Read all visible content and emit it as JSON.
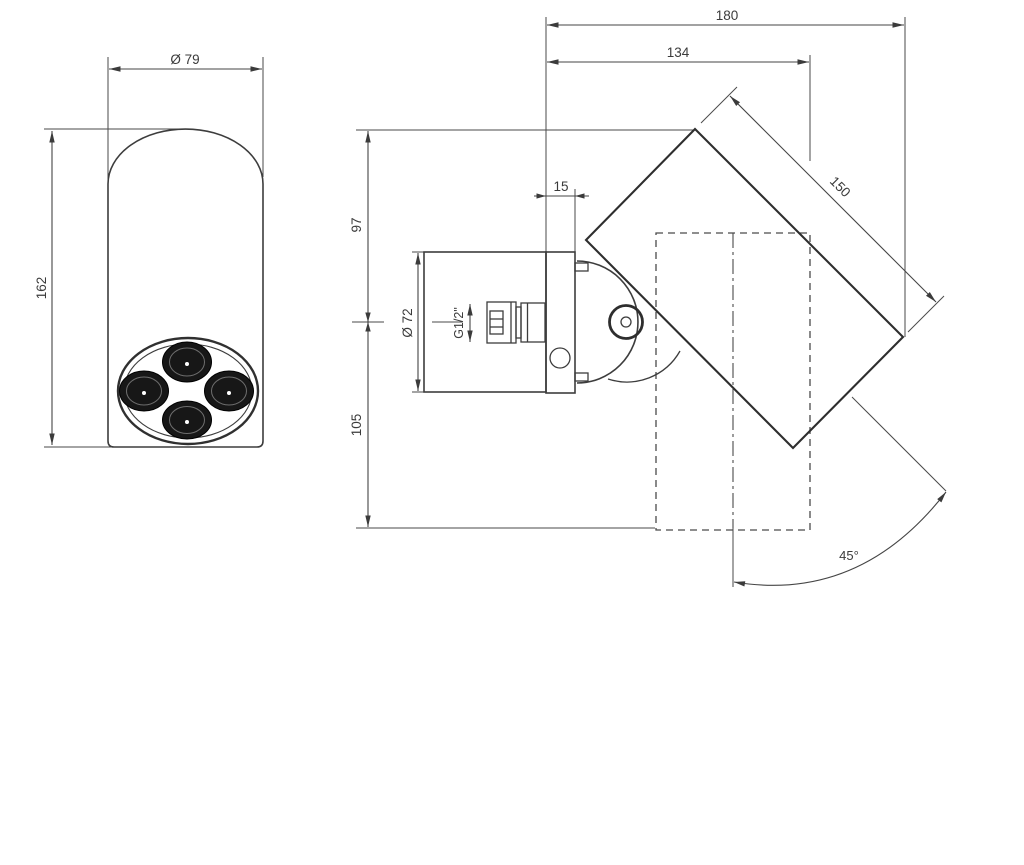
{
  "drawing": {
    "type": "technical-dimension-drawing",
    "views": {
      "front": {
        "name": "front view",
        "dimensions": {
          "diameter": "Ø 79",
          "height": "162"
        }
      },
      "side": {
        "name": "side view",
        "dimensions": {
          "total_depth": "180",
          "head_depth": "134",
          "head_length": "150",
          "plate_thickness": "15",
          "axis_to_top": "97",
          "axis_to_bottom": "105",
          "body_diameter": "Ø 72",
          "thread": "G1/2\"",
          "swivel_angle": "45°"
        }
      }
    },
    "colors": {
      "line": "#3d3d3d",
      "dim_line": "#454545",
      "heavy_line": "#2e2e2e",
      "background": "#ffffff",
      "nozzle_fill": "#171717"
    }
  }
}
